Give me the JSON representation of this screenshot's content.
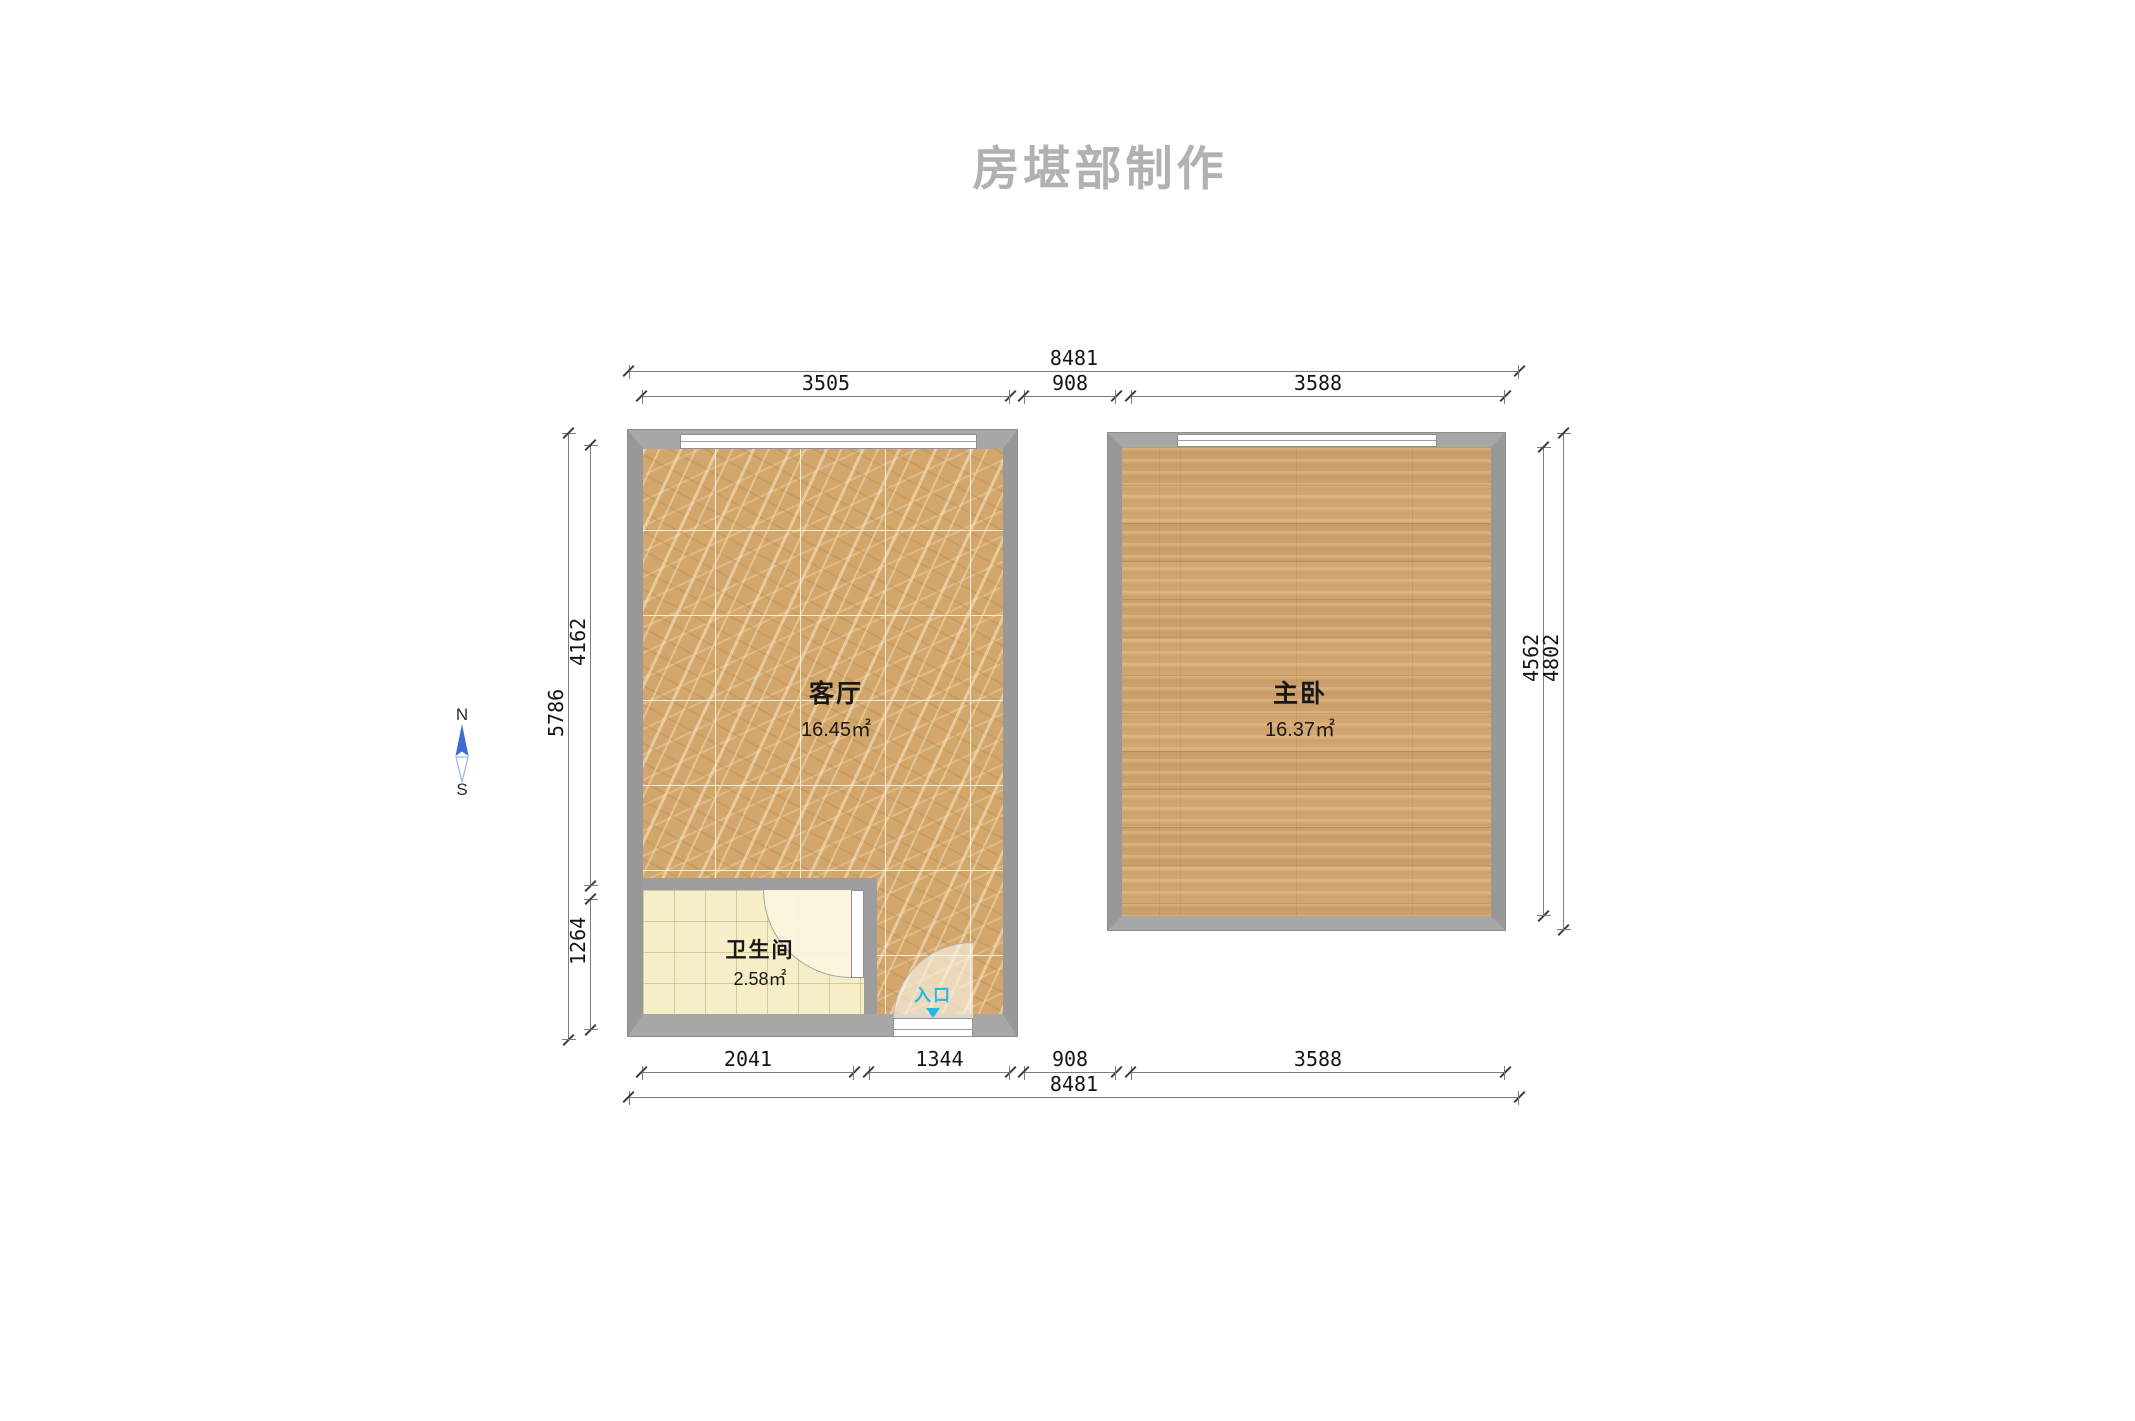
{
  "title": "房堪部制作",
  "compass": {
    "north": "N",
    "south": "S"
  },
  "rooms": {
    "living": {
      "name": "客厅",
      "area": "16.45㎡"
    },
    "master": {
      "name": "主卧",
      "area": "16.37㎡"
    },
    "bathroom": {
      "name": "卫生间",
      "area": "2.58㎡"
    }
  },
  "entry": {
    "label": "入口",
    "color": "#29b6e8"
  },
  "dimensions": {
    "top_overall": "8481",
    "top_segments": [
      "3505",
      "908",
      "3588"
    ],
    "bottom_segments": [
      "2041",
      "1344",
      "908",
      "3588"
    ],
    "bottom_overall": "8481",
    "left_overall": "5786",
    "left_segments": [
      "4162",
      "1264"
    ],
    "right_inner": "4562",
    "right_outer": "4802"
  },
  "colors": {
    "wall_gray": "#9d9d9d",
    "marble_floor": "#d3a76c",
    "wood_floor": "#d2a670",
    "bath_tile": "#f5eec9",
    "entry_cyan": "#29b6e8",
    "compass_blue": "#3a6cd4",
    "title_gray": "#b1b1b1",
    "dimension_line": "#7d7d7d"
  }
}
